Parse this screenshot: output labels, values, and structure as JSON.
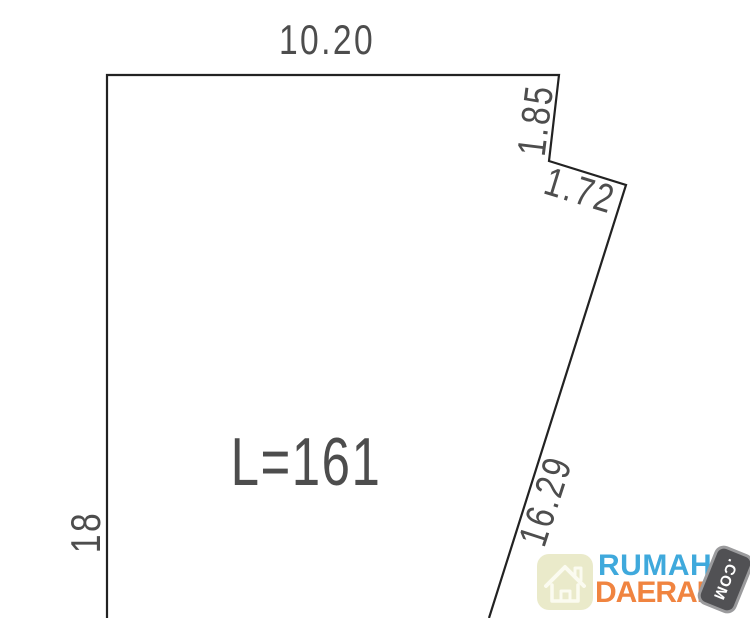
{
  "diagram": {
    "outline_points": "107,618 107,75 559,75 549,161 626,185 489,618",
    "line_color": "#222222",
    "text_color": "#4D4D4D",
    "labels": {
      "top_width": "10.20",
      "left_height": "18",
      "notch_side": "1.85",
      "notch_bottom": "1.72",
      "right_side": "16.29",
      "area": "L=161"
    }
  },
  "watermark": {
    "brand_line1": "RUMAH",
    "brand_line2": "DAERAH",
    "badge_text": ".COM",
    "colors": {
      "brand_line1": "#3FA9DC",
      "brand_line2": "#F08440",
      "badge_bg": "#515154",
      "badge_border": "#9B9B9D",
      "tile_bg": "#EAEACA",
      "house_stroke": "#FBFBF0"
    }
  }
}
